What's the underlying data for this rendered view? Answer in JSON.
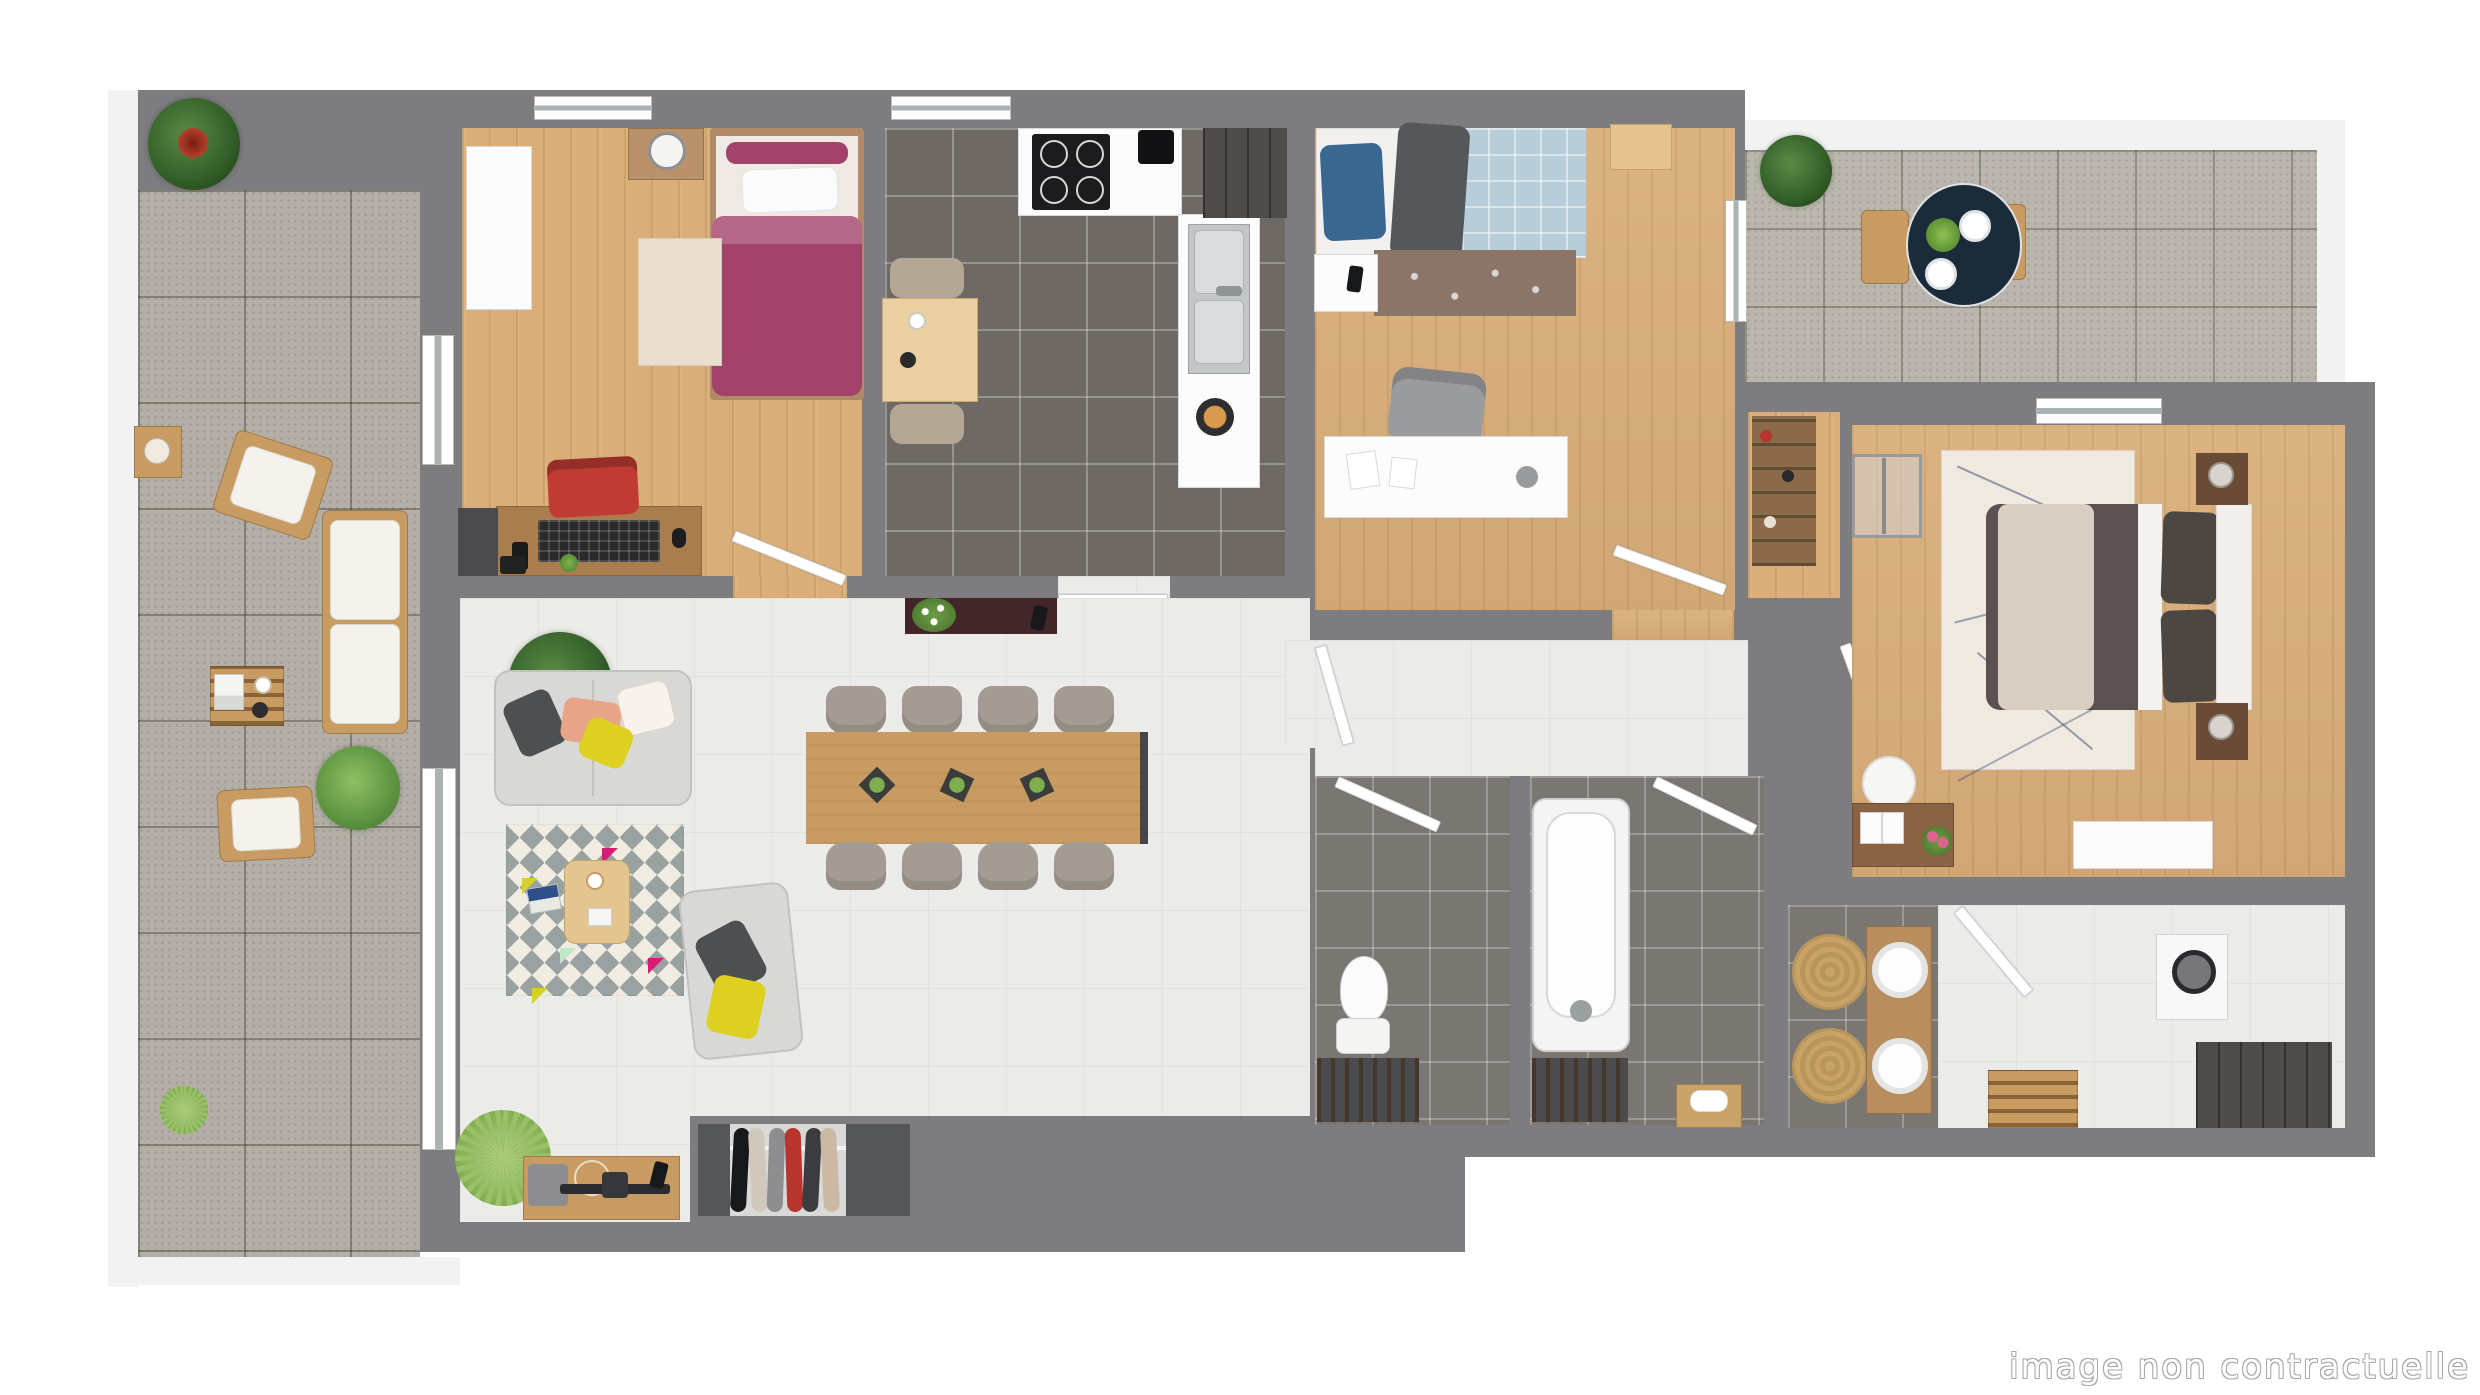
{
  "watermark": "image non contractuelle",
  "palette": {
    "wall": "#7d7d7f",
    "rim": "#f2f2f2",
    "wood": "#d9ae79",
    "wood_furn": "#c89b62",
    "tile_kitchen": "#6e6964",
    "tile_bath": "#7a7672",
    "terrace_tile": "#b3afa6",
    "terrace_tile2": "#bab6ad",
    "floor_light": "#ebebe9",
    "dark_cabinet": "#4b4b4d",
    "sofa_grey": "#d8d8d6",
    "navy_table": "#1c2b3a",
    "jute": "#c8a267",
    "accent_magenta": "#a2426a",
    "accent_blue": "#39678f",
    "duvet_blue": "#b7cdd9",
    "accent_yellow": "#ddd020",
    "accent_red": "#bf3b33",
    "accent_peach": "#e8a487",
    "master_duvet": "#5a5150",
    "master_throw": "#d8cec2",
    "rug_brown": "#8b7569",
    "console_maroon": "#432629"
  }
}
